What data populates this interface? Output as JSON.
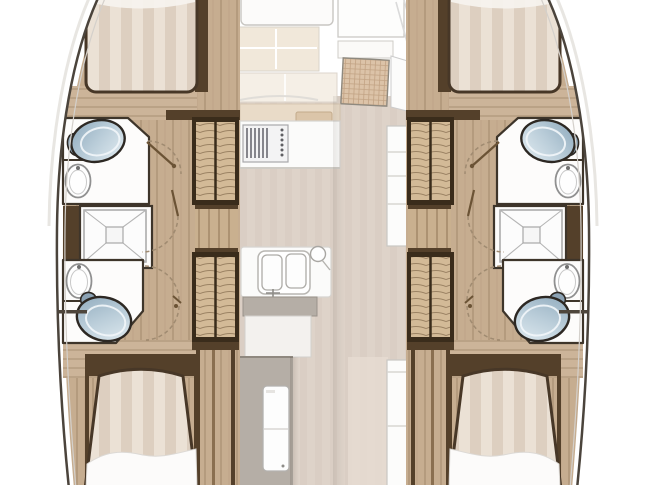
{
  "plan": {
    "type": "catamaran-interior-floorplan",
    "orientation": "bow-up",
    "hulls": [
      {
        "name": "port-hull",
        "features": [
          "forward-berth",
          "forward-head-toilet",
          "forward-head-washbasin",
          "shower-pan",
          "aft-head-toilet",
          "aft-head-washbasin",
          "aft-berth",
          "louvered-locker-forward",
          "louvered-locker-aft",
          "wood-corridor",
          "door-swing-arcs"
        ]
      },
      {
        "name": "starboard-hull",
        "features": [
          "forward-berth",
          "forward-head-toilet",
          "forward-head-washbasin",
          "shower-pan",
          "aft-head-toilet",
          "aft-head-washbasin",
          "aft-berth",
          "louvered-locker-forward",
          "louvered-locker-aft",
          "wood-corridor",
          "door-swing-arcs"
        ]
      }
    ],
    "saloon": {
      "features": [
        "forward-seating",
        "cream-cushions",
        "rattan-dining-table",
        "galley-stove",
        "galley-counter",
        "refrigerator-column",
        "double-sink",
        "sink-counter",
        "sideboard",
        "companionway-grey-panel",
        "companionway-door",
        "aft-cabinet-column"
      ]
    },
    "fixture_counts": {
      "berths": 4,
      "toilets": 4,
      "washbasins": 4,
      "showers": 2,
      "stoves": 1,
      "double_sinks": 1,
      "dining_tables": 1
    }
  },
  "colors": {
    "bg": "#ffffff",
    "hull-line": "#4b443c",
    "hull-inner-line": "#d4d0cb",
    "hull-outer-glow": "#e8e6e2",
    "wood": "#c6ad90",
    "wood2": "#ccb499",
    "wood-line": "#a98f72",
    "wall-dark": "#54402a",
    "stairs-frame": "#3a2c1b",
    "tread": "#d3ba97",
    "tread-line": "#9b8263",
    "plank": "#c9b08f",
    "plank-line": "#8f7356",
    "bed-a": "#ebe1d5",
    "bed-b": "#ddcfc0",
    "bed-border": "#473727",
    "sheet": "#fcfbfa",
    "room-white": "#fdfcfb",
    "room-line": "#3e352a",
    "fixture-dark": "#2d2823",
    "toilet-1": "#8ea9bc",
    "toilet-2": "#bacdd9",
    "toilet-3": "#e3edf2",
    "floor": "#ded3c9",
    "floor-stripe": "#d6c9be",
    "cream": "#f1e8da",
    "rattan": "#dcc3a8",
    "rattan-line": "#c2a384",
    "gray-panel": "#b5aea6",
    "counter-white": "#fbfbfa",
    "counter-line": "#d6d4d0",
    "stove-line": "#72727a",
    "door-arc": "#a08b71",
    "door-leaf": "#6b5335"
  }
}
